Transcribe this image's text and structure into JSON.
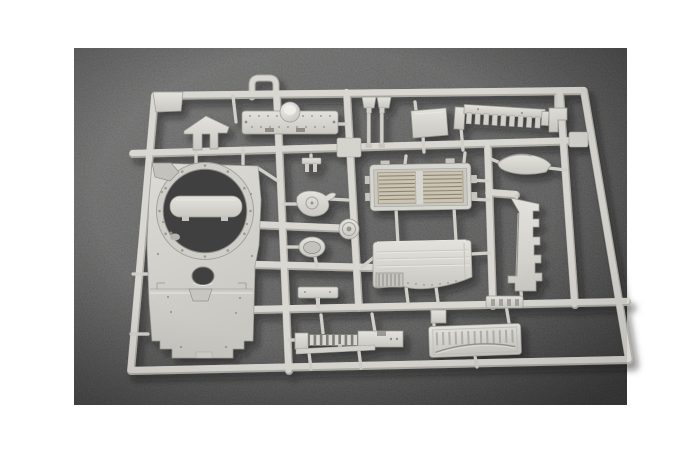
{
  "scene": {
    "description": "Photograph of an unassembled light grey plastic model kit sprue (injection-moulded parts frame) for an armoured vehicle kit, lying on dark grey felt, framed by a white page border",
    "photo": {
      "x": 74,
      "y": 48,
      "width": 553,
      "height": 357
    },
    "colors": {
      "page_bg": "#ffffff",
      "felt_light": "#6d6d6d",
      "felt_mid": "#545454",
      "felt_dark": "#3d3d3d",
      "plastic_base": "#d8d7d2",
      "plastic_bright": "#eceae6",
      "plastic_shade": "#aeada6",
      "plastic_part": "#d9d8d3",
      "gate": "#d0cfc9",
      "outline": "#9b9a93",
      "recess": "#c6c5bf",
      "slat_beige": "#cbc4b3",
      "slat_gap": "#8e8675",
      "hole_dark": "#414141"
    },
    "sprue": {
      "label": "model-kit-sprue"
    },
    "parts": [
      {
        "id": "turret-roof-plate",
        "label": "large turret roof plate with round turret-ring opening and stepped lower plate"
      },
      {
        "id": "turret-ring-insert",
        "label": "capsule-shaped insert moulded across the turret ring opening"
      },
      {
        "id": "splash-guard",
        "label": "small house-shaped splash guard"
      },
      {
        "id": "top-deck-plate",
        "label": "long deck plate with central dome and rivet detail"
      },
      {
        "id": "vent-pins",
        "label": "pair of mushroom-headed vent pins"
      },
      {
        "id": "square-hatch-panel",
        "label": "plain square hatch panel"
      },
      {
        "id": "toothed-mount-rail",
        "label": "toothed mounting rail with comb of lugs"
      },
      {
        "id": "step-bracket",
        "label": "small stepped bracket"
      },
      {
        "id": "curved-fender",
        "label": "curved fender blade"
      },
      {
        "id": "radiator-grille-box",
        "label": "radiator box with two louvered grille panels"
      },
      {
        "id": "engine-deck-panel",
        "label": "smooth engine deck panel with wavy lower edge and small grille"
      },
      {
        "id": "notched-side-bracket",
        "label": "long vertical bracket with notched right edge"
      },
      {
        "id": "small-t-bracket",
        "label": "small T-shaped bracket"
      },
      {
        "id": "pump-housing",
        "label": "round pump housing with spout"
      },
      {
        "id": "hub-disc",
        "label": "small wheel hub disc"
      },
      {
        "id": "oval-dish",
        "label": "oval dished hatch"
      },
      {
        "id": "mounting-bar",
        "label": "small mounting bar with stem"
      },
      {
        "id": "louvered-strip",
        "label": "long louvered strip with end blocks"
      },
      {
        "id": "tow-rod",
        "label": "thin tow rod"
      },
      {
        "id": "ribbed-rear-door",
        "label": "ribbed rear door panel with arched lower edge"
      },
      {
        "id": "slotted-bar",
        "label": "short slotted bar"
      },
      {
        "id": "carry-loop",
        "label": "moulded carrying loop on the top rail"
      }
    ]
  }
}
